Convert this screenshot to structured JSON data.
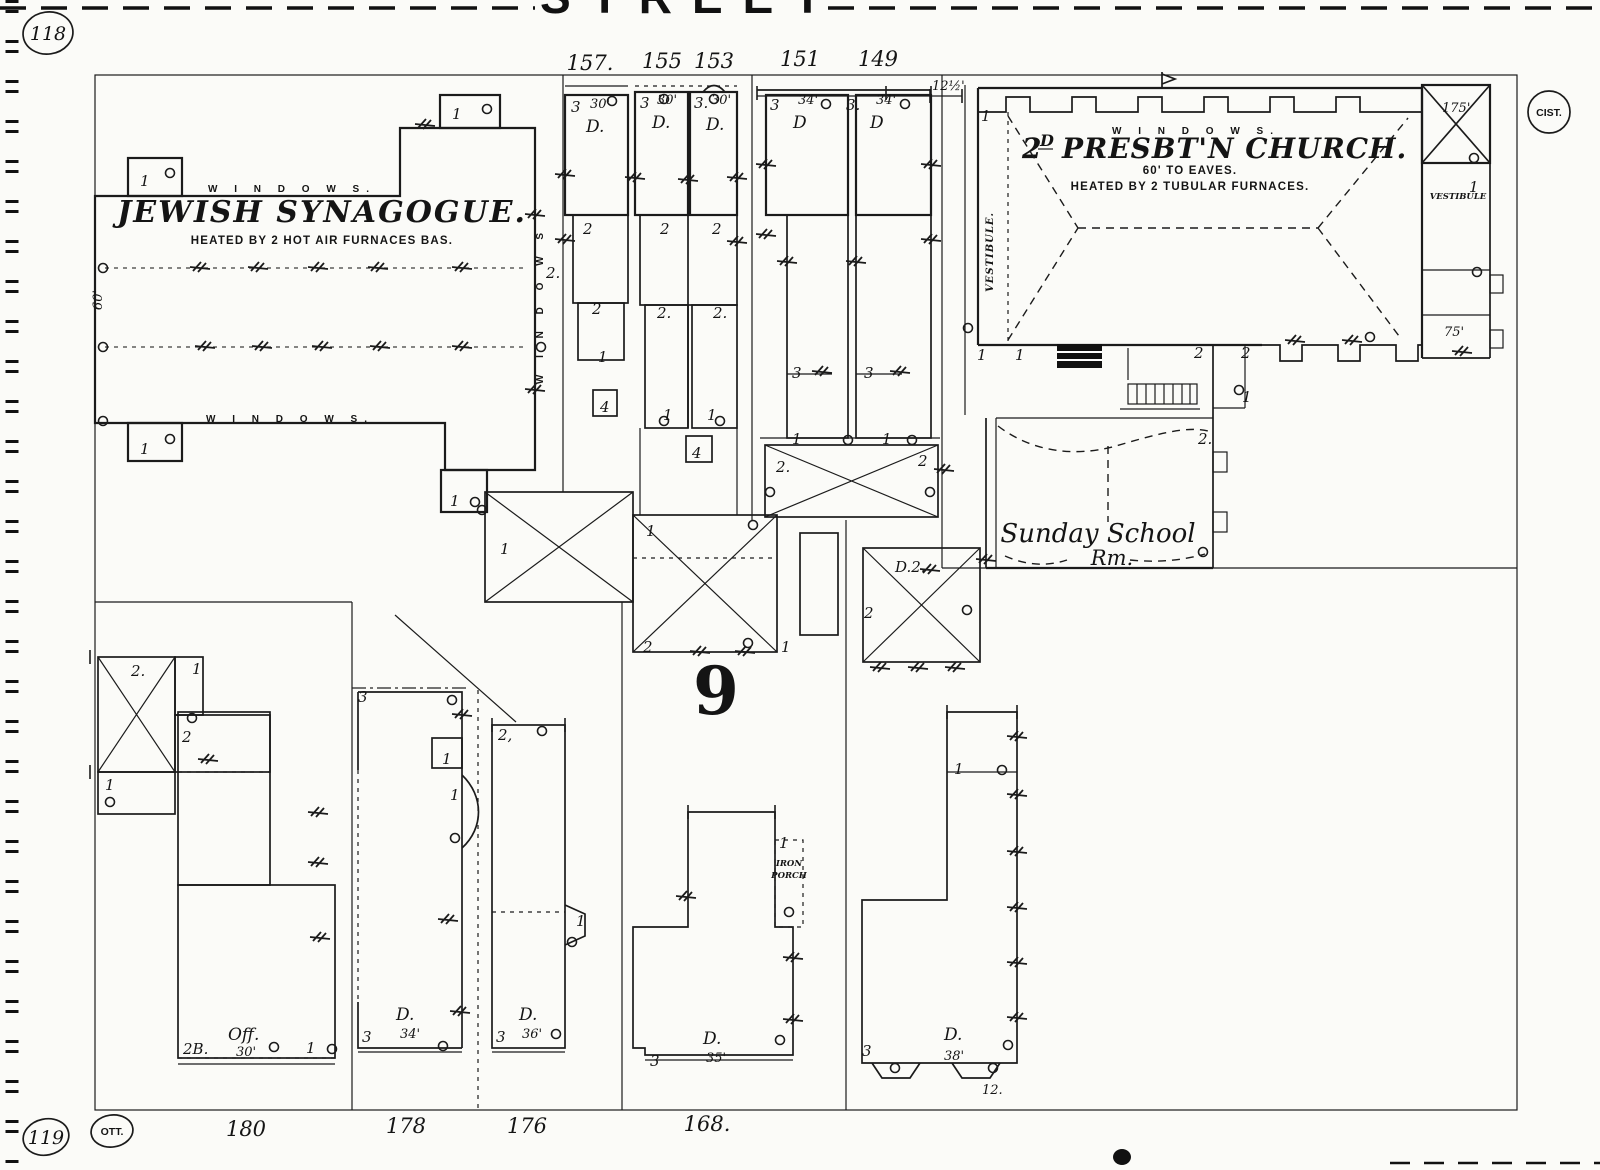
{
  "street": {
    "name": "STREET"
  },
  "pages": {
    "top_left": "118",
    "bottom_left": "119",
    "ott": "OTT.",
    "cist": "CIST."
  },
  "block": {
    "number": "9"
  },
  "synagogue": {
    "title": "JEWISH SYNAGOGUE.",
    "subtitle": "HEATED BY 2 HOT AIR FURNACES BAS.",
    "windows_top": "W I N D O W S.",
    "windows_bottom": "W I N D O W S.",
    "windows_right": "W I N D O W S",
    "depth": "60'"
  },
  "church": {
    "t1": "2",
    "t2": "D",
    "t3": "PRESBT'N CHURCH.",
    "eaves": "60' TO EAVES.",
    "heat": "HEATED BY 2 TUBULAR FURNACES.",
    "windows_top": "W I N D O W S.",
    "vestibule_left": "VESTIBULE.",
    "vestibule_right": "VESTIBULE",
    "tower_dim": "175'",
    "setback": "12½'",
    "annex_dim": "75'",
    "ss1": "Sunday School",
    "ss2": "Rm."
  },
  "row_houses": {
    "addresses": {
      "h157": "157.",
      "h155": "155",
      "h153": "153",
      "h151": "151",
      "h149": "149"
    },
    "h157": {
      "stories": "3",
      "depth": "30'",
      "use": "D."
    },
    "h155": {
      "stories": "3",
      "depth": "30'",
      "use": "D."
    },
    "h153": {
      "stories": "3.",
      "depth": "30'",
      "use": "D."
    },
    "h151": {
      "stories": "3",
      "depth": "34'",
      "use": "D"
    },
    "h149": {
      "stories": "3.",
      "depth": "34'",
      "use": "D"
    }
  },
  "bottom_houses": {
    "street_numbers": {
      "n180": "180",
      "n178": "178",
      "n176": "176",
      "n168": "168."
    },
    "h180": {
      "stories": "2B.",
      "use": "Off.",
      "depth": "30'"
    },
    "h178": {
      "stories": "3",
      "use": "D.",
      "depth": "34'"
    },
    "h176": {
      "stories": "3",
      "use": "D.",
      "depth": "36'"
    },
    "h168": {
      "stories": "3",
      "use": "D.",
      "depth": "35'",
      "porch1": "IRON",
      "porch2": "PORCH"
    },
    "h_right": {
      "stories": "3",
      "use": "D.",
      "depth": "38'",
      "bay": "12."
    }
  },
  "annotations": [
    {
      "x": 583,
      "y": 234,
      "t": "2"
    },
    {
      "x": 660,
      "y": 234,
      "t": "2"
    },
    {
      "x": 712,
      "y": 234,
      "t": "2"
    },
    {
      "x": 592,
      "y": 314,
      "t": "2"
    },
    {
      "x": 657,
      "y": 318,
      "t": "2."
    },
    {
      "x": 713,
      "y": 318,
      "t": "2."
    },
    {
      "x": 598,
      "y": 362,
      "t": "1"
    },
    {
      "x": 663,
      "y": 420,
      "t": "1"
    },
    {
      "x": 707,
      "y": 420,
      "t": "1"
    },
    {
      "x": 600,
      "y": 412,
      "t": "4",
      "fs": 13
    },
    {
      "x": 692,
      "y": 458,
      "t": "4",
      "fs": 13
    },
    {
      "x": 792,
      "y": 378,
      "t": "3"
    },
    {
      "x": 864,
      "y": 378,
      "t": "3"
    },
    {
      "x": 792,
      "y": 444,
      "t": "1"
    },
    {
      "x": 882,
      "y": 444,
      "t": "1"
    },
    {
      "x": 776,
      "y": 472,
      "t": "2."
    },
    {
      "x": 918,
      "y": 466,
      "t": "2"
    },
    {
      "x": 140,
      "y": 186,
      "t": "1"
    },
    {
      "x": 140,
      "y": 454,
      "t": "1"
    },
    {
      "x": 452,
      "y": 119,
      "t": "1"
    },
    {
      "x": 450,
      "y": 506,
      "t": "1"
    },
    {
      "x": 546,
      "y": 278,
      "t": "2."
    },
    {
      "x": 500,
      "y": 554,
      "t": "1"
    },
    {
      "x": 646,
      "y": 536,
      "t": "1"
    },
    {
      "x": 643,
      "y": 652,
      "t": "2"
    },
    {
      "x": 781,
      "y": 652,
      "t": "1"
    },
    {
      "x": 895,
      "y": 572,
      "t": "D.2."
    },
    {
      "x": 864,
      "y": 618,
      "t": "2"
    },
    {
      "x": 981,
      "y": 121,
      "t": "1"
    },
    {
      "x": 977,
      "y": 360,
      "t": "1"
    },
    {
      "x": 1015,
      "y": 360,
      "t": "1"
    },
    {
      "x": 1194,
      "y": 358,
      "t": "2"
    },
    {
      "x": 1241,
      "y": 358,
      "t": "2"
    },
    {
      "x": 1242,
      "y": 402,
      "t": "1"
    },
    {
      "x": 1198,
      "y": 444,
      "t": "2."
    },
    {
      "x": 1469,
      "y": 192,
      "t": "1"
    },
    {
      "x": 131,
      "y": 676,
      "t": "2."
    },
    {
      "x": 192,
      "y": 674,
      "t": "1"
    },
    {
      "x": 182,
      "y": 742,
      "t": "2"
    },
    {
      "x": 105,
      "y": 790,
      "t": "1"
    },
    {
      "x": 358,
      "y": 702,
      "t": "3"
    },
    {
      "x": 498,
      "y": 740,
      "t": "2,"
    },
    {
      "x": 442,
      "y": 764,
      "t": "1",
      "fs": 13
    },
    {
      "x": 450,
      "y": 800,
      "t": "1"
    },
    {
      "x": 576,
      "y": 926,
      "t": "1",
      "fs": 13
    },
    {
      "x": 954,
      "y": 774,
      "t": "1"
    },
    {
      "x": 306,
      "y": 1053,
      "t": "1"
    },
    {
      "x": 779,
      "y": 848,
      "t": "1",
      "fs": 12
    }
  ]
}
